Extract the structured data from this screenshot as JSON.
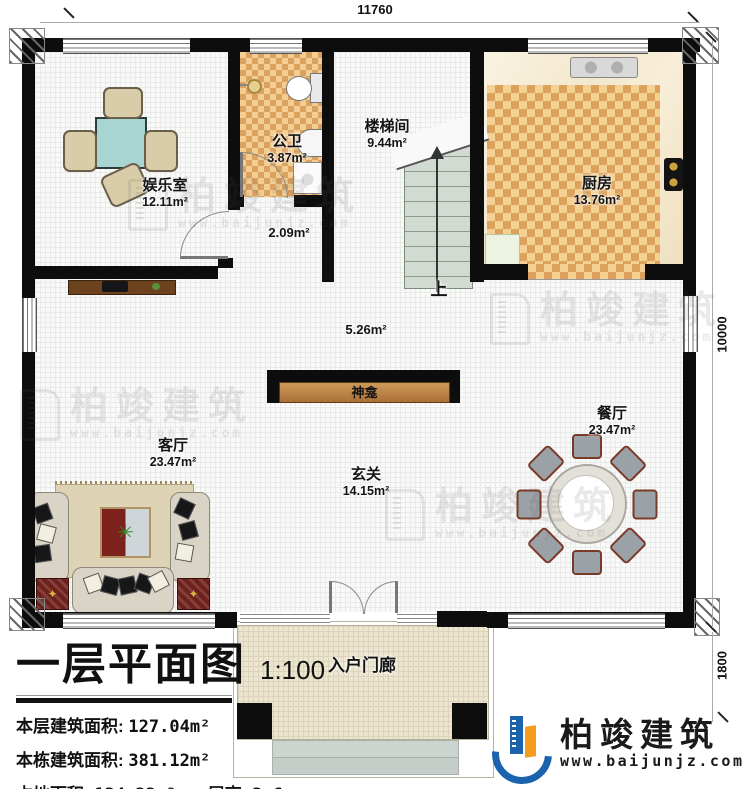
{
  "dimensions": {
    "top": "11760",
    "right": "10000",
    "bottom_right": "1800"
  },
  "rooms": {
    "entertainment": {
      "name": "娱乐室",
      "area": "12.11m²"
    },
    "bathroom": {
      "name": "公卫",
      "area": "3.87m²"
    },
    "stairwell": {
      "name": "楼梯间",
      "area": "9.44m²"
    },
    "kitchen": {
      "name": "厨房",
      "area": "13.76m²"
    },
    "hallway": {
      "area": "2.09m²"
    },
    "corridor": {
      "area": "5.26m²"
    },
    "living": {
      "name": "客厅",
      "area": "23.47m²"
    },
    "foyer": {
      "name": "玄关",
      "area": "14.15m²"
    },
    "dining": {
      "name": "餐厅",
      "area": "23.47m²"
    },
    "porch": {
      "name": "入户门廊"
    },
    "shrine": {
      "name": "神龛"
    },
    "stairs_up": "上"
  },
  "title_block": {
    "title": "一层平面图",
    "scale": "1:100",
    "floor_area_label": "本层建筑面积:",
    "floor_area_value": "127.04m²",
    "total_area_label": "本栋建筑面积:",
    "total_area_value": "381.12m²",
    "footprint_label": "占地面积:",
    "footprint_value": "134.23m²",
    "height_label": "层高:",
    "height_value": "3.6m"
  },
  "brand": {
    "name": "柏竣建筑",
    "url": "www.baijunjz.com"
  },
  "watermark": {
    "name": "柏竣建筑",
    "url": "www.baijunjz.com"
  },
  "colors": {
    "wall": "#0d0d0d",
    "tile_dark": "#dca15d",
    "tile_light": "#f5d093",
    "stair_green": "#d2dbd2",
    "table_teal": "#a8d5d1",
    "mat_red": "#6e201b",
    "brand_blue": "#1b63ad",
    "brand_orange": "#f59b20"
  }
}
